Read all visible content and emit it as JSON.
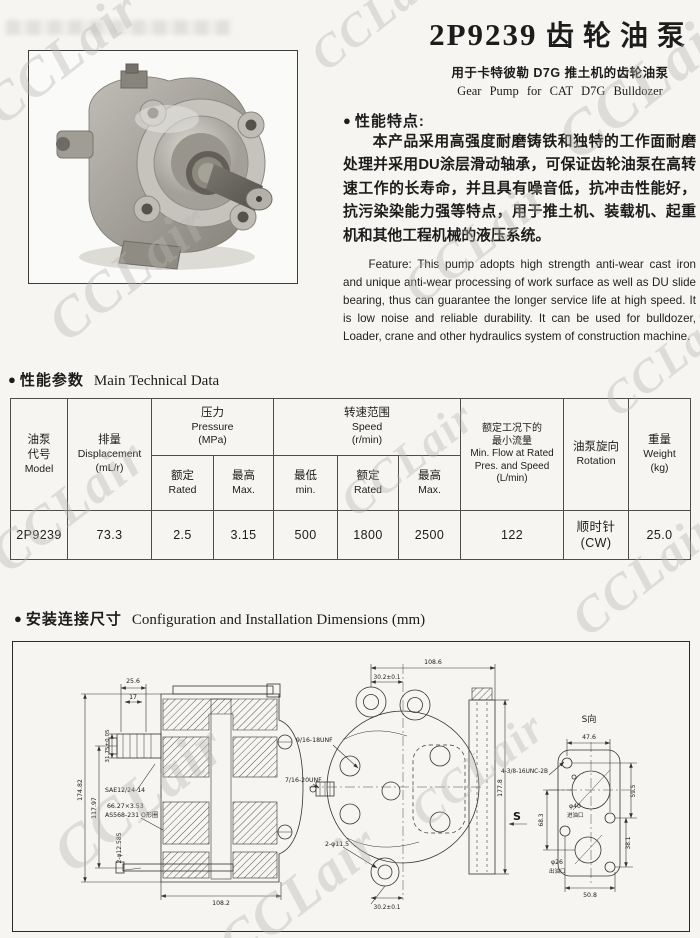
{
  "watermark": {
    "text": "CCLair"
  },
  "ui": {
    "bullet": "●"
  },
  "header": {
    "model": "2P9239",
    "title_cn": "齿轮油泵",
    "subtitle_cn": "用于卡特彼勒 D7G 推土机的齿轮油泵",
    "subtitle_en": "Gear Pump for CAT D7G Bulldozer"
  },
  "features": {
    "heading": "性能特点:",
    "body_cn": "本产品采用高强度耐磨铸铁和独特的工作面耐磨处理并采用DU涂层滑动轴承，可保证齿轮油泵在高转速工作的长寿命，并且具有噪音低，抗冲击性能好，抗污染染能力强等特点，用于推土机、装载机、起重机和其他工程机械的液压系统。",
    "body_en": "Feature: This pump adopts high strength anti-wear cast iron and unique anti-wear processing of work surface as well as DU slide bearing, thus can guarantee the longer service life at high speed. It is low noise and reliable durability. It can be used for bulldozer, Loader, crane and other hydraulics system of construction machine."
  },
  "tech": {
    "heading_cn": "性能参数",
    "heading_en": "Main Technical Data"
  },
  "table": {
    "model": {
      "l1": "油泵",
      "l2": "代号",
      "l3": "Model"
    },
    "displacement": {
      "l1": "排量",
      "l2": "Displacement",
      "l3": "(mL/r)"
    },
    "pressure": {
      "l1": "压力",
      "l2": "Pressure",
      "l3": "(MPa)"
    },
    "p_rated": {
      "l1": "额定",
      "l2": "Rated"
    },
    "p_max": {
      "l1": "最高",
      "l2": "Max."
    },
    "speed": {
      "l1": "转速范围",
      "l2": "Speed",
      "l3": "(r/min)"
    },
    "s_min": {
      "l1": "最低",
      "l2": "min."
    },
    "s_rated": {
      "l1": "额定",
      "l2": "Rated"
    },
    "s_max": {
      "l1": "最高",
      "l2": "Max."
    },
    "flow": {
      "l1": "额定工况下的",
      "l2": "最小流量",
      "l3": "Min. Flow at Rated",
      "l4": "Pres. and Speed",
      "l5": "(L/min)"
    },
    "rotation": {
      "l1": "油泵旋向",
      "l2": "Rotation"
    },
    "weight": {
      "l1": "重量",
      "l2": "Weight",
      "l3": "(kg)"
    },
    "row": {
      "model": "2P9239",
      "displacement": "73.3",
      "p_rated": "2.5",
      "p_max": "3.15",
      "s_min": "500",
      "s_rated": "1800",
      "s_max": "2500",
      "flow": "122",
      "rotation_l1": "顺时针",
      "rotation_l2": "(CW)",
      "weight": "25.0"
    }
  },
  "install": {
    "heading_cn": "安装连接尺寸",
    "heading_en": "Configuration and Installation Dimensions (mm)"
  },
  "drawing": {
    "left": {
      "dim_top1": "25.6",
      "dim_top2": "17",
      "dim_shaft": "31.75±0.05",
      "dim_h1": "174.82",
      "dim_h2": "117.97",
      "spline": "SAE12/24-14",
      "oring_size": "66.27×3.53",
      "oring_std": "AS568-231 O形圈",
      "holes": "2-φ12.585",
      "dim_bottom": "108.2"
    },
    "front": {
      "dim_top1": "108.6",
      "dim_top2": "30.2±0.1",
      "port_in": "9/16-18UNF",
      "port_out": "7/16-20UNF",
      "holes": "2-φ11.5",
      "dim_bottom": "30.2±0.1",
      "dim_height": "177.8",
      "mount_bolts": "4-3/8-16UNC-2B",
      "view_mark": "S"
    },
    "s_view": {
      "title": "S向",
      "dim_top": "47.6",
      "dim_r1": "59.5",
      "dim_l1": "68.3",
      "dim_r2": "38.1",
      "dim_bottom": "50.8",
      "inlet_dia": "φ40",
      "inlet_label": "进油口",
      "outlet_dia": "φ26",
      "outlet_label": "出油口"
    }
  }
}
